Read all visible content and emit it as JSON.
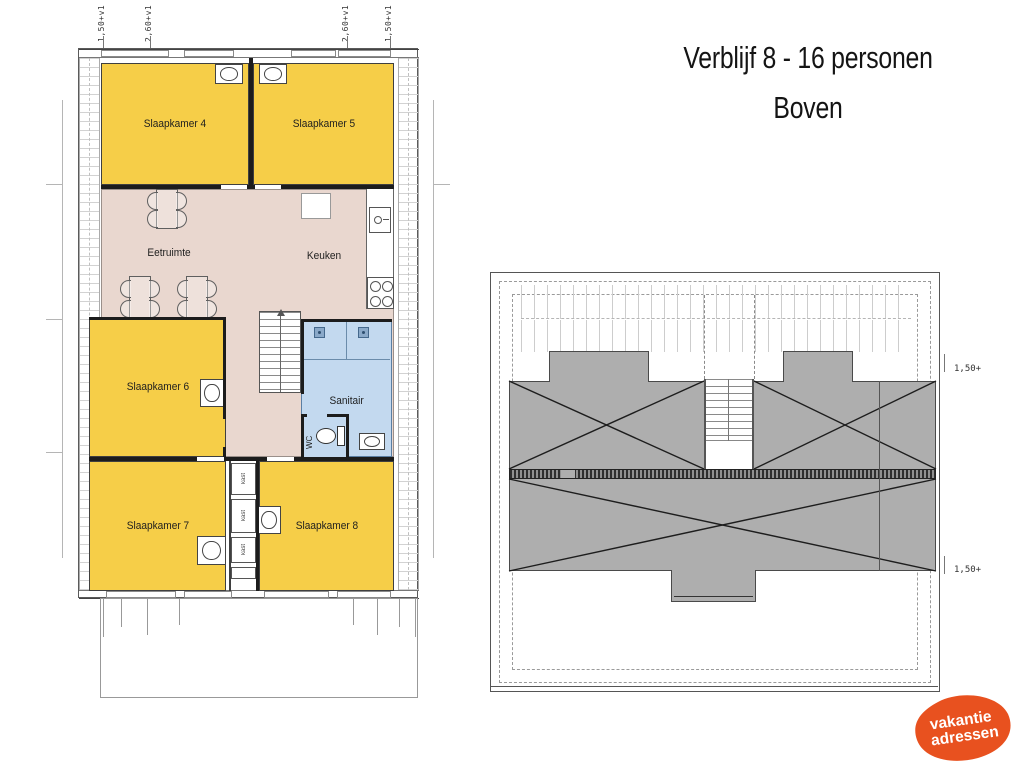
{
  "title": {
    "line1": "Verblijf 8 - 16 personen",
    "line2": "Boven"
  },
  "floor_plan": {
    "rooms": {
      "slaapkamer4": "Slaapkamer 4",
      "slaapkamer5": "Slaapkamer 5",
      "eetruimte": "Eetruimte",
      "keuken": "Keuken",
      "slaapkamer6": "Slaapkamer 6",
      "sanitair": "Sanitair",
      "wc": "WC",
      "slaapkamer7": "Slaapkamer 7",
      "slaapkamer8": "Slaapkamer 8"
    },
    "closet_labels": [
      "kast",
      "kast",
      "kast"
    ],
    "dimension_labels": [
      "1,50+v1",
      "2,60+v1",
      "2,60+v1",
      "1,50+v1"
    ]
  },
  "roof_plan": {
    "dimension_labels": [
      "1,50+",
      "1,50+"
    ]
  },
  "logo": {
    "line1": "vakantie",
    "line2": "adressen"
  },
  "colors": {
    "bedroom_yellow": "#F6CE48",
    "living_beige": "#E9D7CF",
    "sanitair_blue": "#C3D9EF",
    "roof_gray": "#AEAEAE",
    "logo_orange": "#E8511F",
    "wall_dark": "#1c1c1c"
  }
}
